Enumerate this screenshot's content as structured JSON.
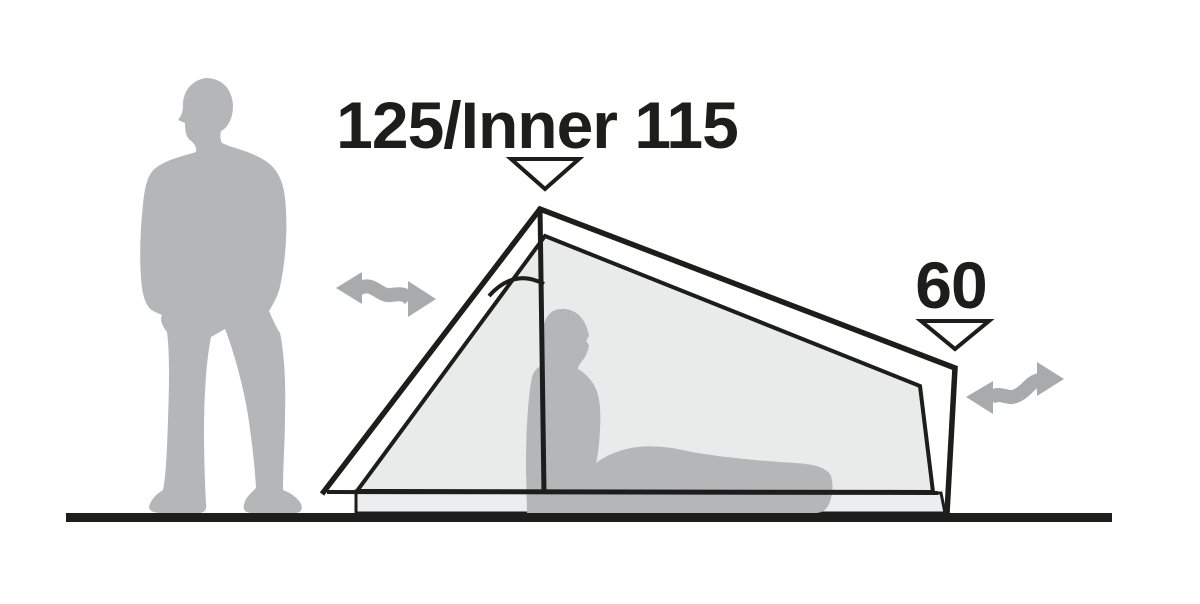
{
  "diagram": {
    "title": "Tent side profile with height measurements",
    "measurements": {
      "peak": "125/Inner 115",
      "rear": "60"
    },
    "colors": {
      "line": "#1d1d1b",
      "figure": "#b4b6b7",
      "arrow": "#a8aaac",
      "inner_fill": "#e9ebeb",
      "floor_fill": "#ebedee",
      "marker_fill": "#ffffff",
      "background": "#ffffff"
    },
    "icons": {
      "peak_marker": "triangle-down-icon",
      "rear_marker": "triangle-down-icon",
      "front_entrance": "double-wavy-arrow-icon",
      "rear_entrance": "double-wavy-arrow-icon"
    }
  }
}
